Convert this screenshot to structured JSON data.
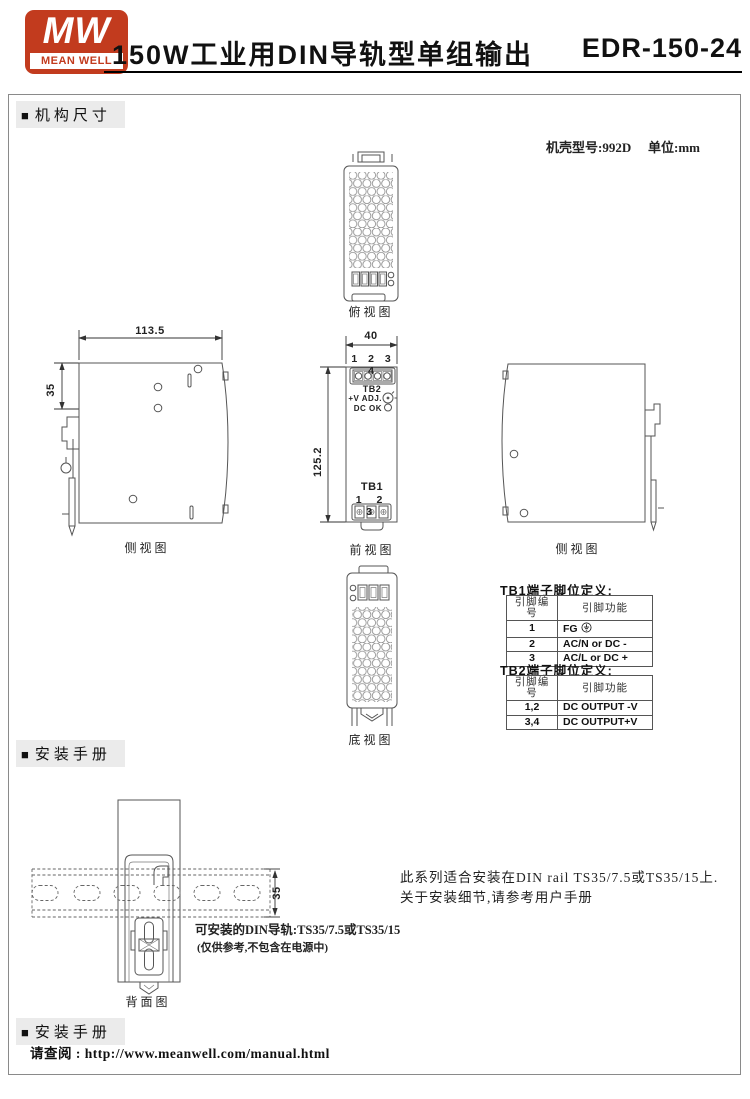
{
  "colors": {
    "brand_red": "#c23b1e",
    "line_gray": "#555555"
  },
  "header": {
    "logo_mw": "MW",
    "logo_brand": "MEAN WELL",
    "title": "150W工业用DIN导轨型单组输出",
    "model": "EDR-150-24"
  },
  "mech": {
    "section": "机构尺寸",
    "case_no": "机壳型号:992D",
    "unit": "单位:mm",
    "labels": {
      "top": "俯视图",
      "side_left": "侧视图",
      "front": "前视图",
      "side_right": "侧视图",
      "bottom": "底视图"
    },
    "dims": {
      "width": "113.5",
      "rail": "35",
      "front_width": "40",
      "height": "125.2"
    },
    "front": {
      "tb2_pins": "1 2 3 4",
      "tb2": "TB2",
      "vadj": "+V ADJ.",
      "dcok": "DC OK",
      "tb1": "TB1",
      "tb1_pins": "1 2 3"
    },
    "tb1": {
      "title": "TB1端子脚位定义:",
      "col_pin": "引脚编号",
      "col_func": "引脚功能",
      "rows": [
        {
          "pin": "1",
          "func": "FG"
        },
        {
          "pin": "2",
          "func": "AC/N or DC -"
        },
        {
          "pin": "3",
          "func": "AC/L or DC +"
        }
      ]
    },
    "tb2": {
      "title": "TB2端子脚位定义:",
      "col_pin": "引脚编号",
      "col_func": "引脚功能",
      "rows": [
        {
          "pin": "1,2",
          "func": "DC OUTPUT -V"
        },
        {
          "pin": "3,4",
          "func": "DC OUTPUT+V"
        }
      ]
    }
  },
  "install": {
    "section": "安装手册",
    "rear_label": "背面图",
    "rail_dim": "35",
    "din_note": "可安装的DIN导轨:TS35/7.5或TS35/15",
    "din_note_sub": "(仅供参考,不包含在电源中)",
    "note_line1": "此系列适合安装在DIN rail TS35/7.5或TS35/15上.",
    "note_line2": "关于安装细节,请参考用户手册"
  },
  "manual": {
    "section": "安装手册",
    "text": "请查阅 : http://www.meanwell.com/manual.html"
  }
}
